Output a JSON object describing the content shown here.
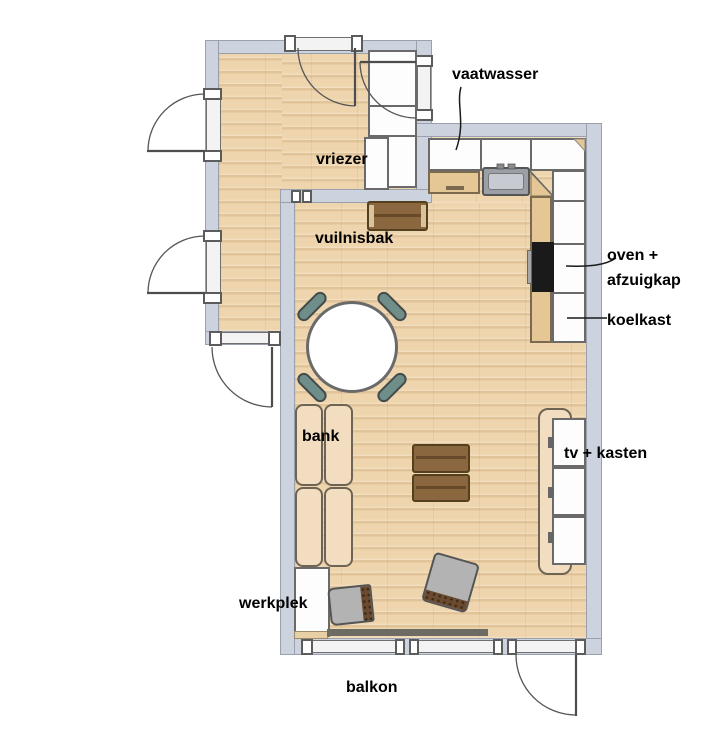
{
  "labels": {
    "vaatwasser": "vaatwasser",
    "vriezer": "vriezer",
    "vuilnisbak": "vuilnisbak",
    "oven_afzuigkap": "oven +\nafzuigkap",
    "koelkast": "koelkast",
    "bank": "bank",
    "tv_kasten": "tv + kasten",
    "werkplek": "werkplek",
    "balkon": "balkon"
  },
  "colors": {
    "wall": "#cdd3de",
    "wall_line": "#9aa1ac",
    "floor": "#efd5ad",
    "counter_white": "#fdfdfd",
    "cabinet_wood": "#e5c795",
    "crate_wood": "#8a673f",
    "chair_teal": "#6f8d89",
    "sofa": "#f3ddc1",
    "oven": "#1a1a1a",
    "gray_chair": "#b3b3b3",
    "label_text": "#000000"
  }
}
